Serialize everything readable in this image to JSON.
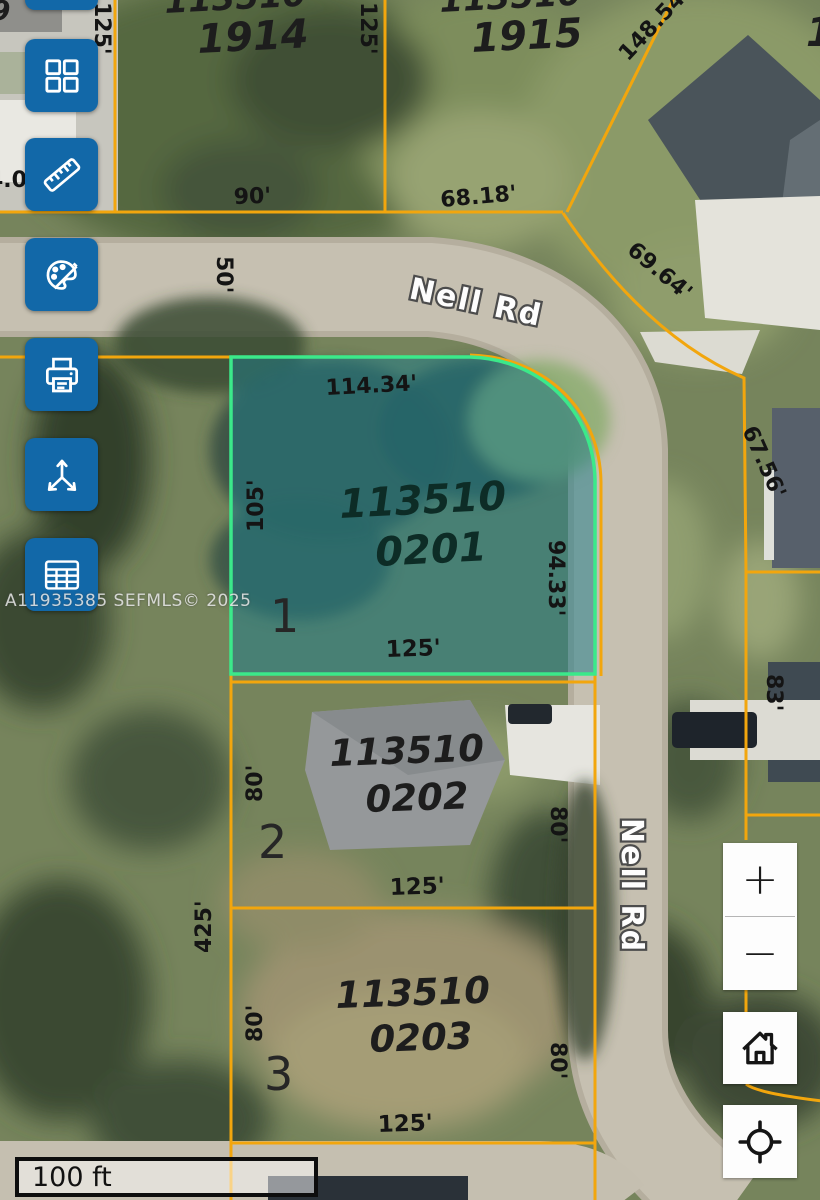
{
  "watermark": "A11935385 SEFMLS© 2025",
  "scale_bar": {
    "label": "100 ft"
  },
  "toolbar": {
    "buttons": [
      {
        "name": "layout-grid"
      },
      {
        "name": "ruler"
      },
      {
        "name": "palette"
      },
      {
        "name": "printer"
      },
      {
        "name": "share-arrows"
      },
      {
        "name": "table"
      }
    ]
  },
  "zoom_controls": {
    "zoom_in": "+",
    "zoom_out": "−"
  },
  "map": {
    "streets": {
      "nell_top": "Nell Rd",
      "nell_right": "Nell Rd"
    },
    "parcels": {
      "p1914": {
        "id_top": "113510",
        "id_bottom": "1914"
      },
      "p1915": {
        "id_top": "113510",
        "id_bottom": "1915"
      },
      "p0201": {
        "id_top": "113510",
        "id_bottom": "0201",
        "lot": "1",
        "highlighted": true
      },
      "p0202": {
        "id_top": "113510",
        "id_bottom": "0202",
        "lot": "2"
      },
      "p0203": {
        "id_top": "113510",
        "id_bottom": "0203",
        "lot": "3"
      }
    },
    "dimensions": {
      "d125_top_left": "125'",
      "d125_top_mid": "125'",
      "d148_54": "148.54'",
      "d90": "90'",
      "d68_18": "68.18'",
      "d50": "50'",
      "d69_64": "69.64'",
      "d4_0": "4.0'",
      "d114_34": "114.34'",
      "d105": "105'",
      "d94_33": "94.33'",
      "d67_56": "67.56'",
      "d125_0201": "125'",
      "d83": "83'",
      "d80_0202_left": "80'",
      "d80_0202_right": "80'",
      "d125_0202": "125'",
      "d425": "425'",
      "d80_0203_left": "80'",
      "d80_0203_right": "80'",
      "d125_0203": "125'"
    },
    "partials": {
      "top_left_digit": "9",
      "top_right_digit": "1"
    }
  },
  "colors": {
    "toolbar_blue": "#1268a8",
    "parcel_line": "#f2a60d",
    "highlight_stroke": "#3be98a",
    "highlight_fill": "rgba(30,125,138,0.52)",
    "road": "#c6c0b1"
  }
}
